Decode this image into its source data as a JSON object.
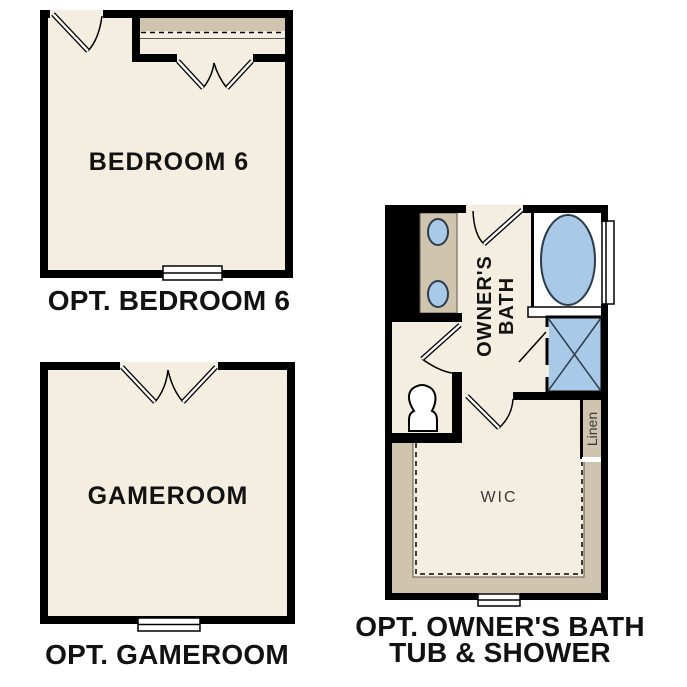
{
  "colors": {
    "floor": "#f4eee1",
    "cabinet": "#cfc5ae",
    "fixture_blue": "#a9c9e8",
    "fixture_outline": "#2e3d49",
    "wall": "#000000",
    "label": "#121212",
    "label_gray": "#3a3a3a"
  },
  "bedroom6": {
    "label": "BEDROOM 6",
    "caption": "OPT. BEDROOM 6"
  },
  "gameroom": {
    "label": "GAMEROOM",
    "caption": "OPT. GAMEROOM"
  },
  "owners_bath": {
    "label_line1": "OWNER'S",
    "label_line2": "BATH",
    "wic_label": "WIC",
    "linen_label": "Linen",
    "caption_line1": "OPT. OWNER'S BATH",
    "caption_line2": "TUB & SHOWER"
  }
}
